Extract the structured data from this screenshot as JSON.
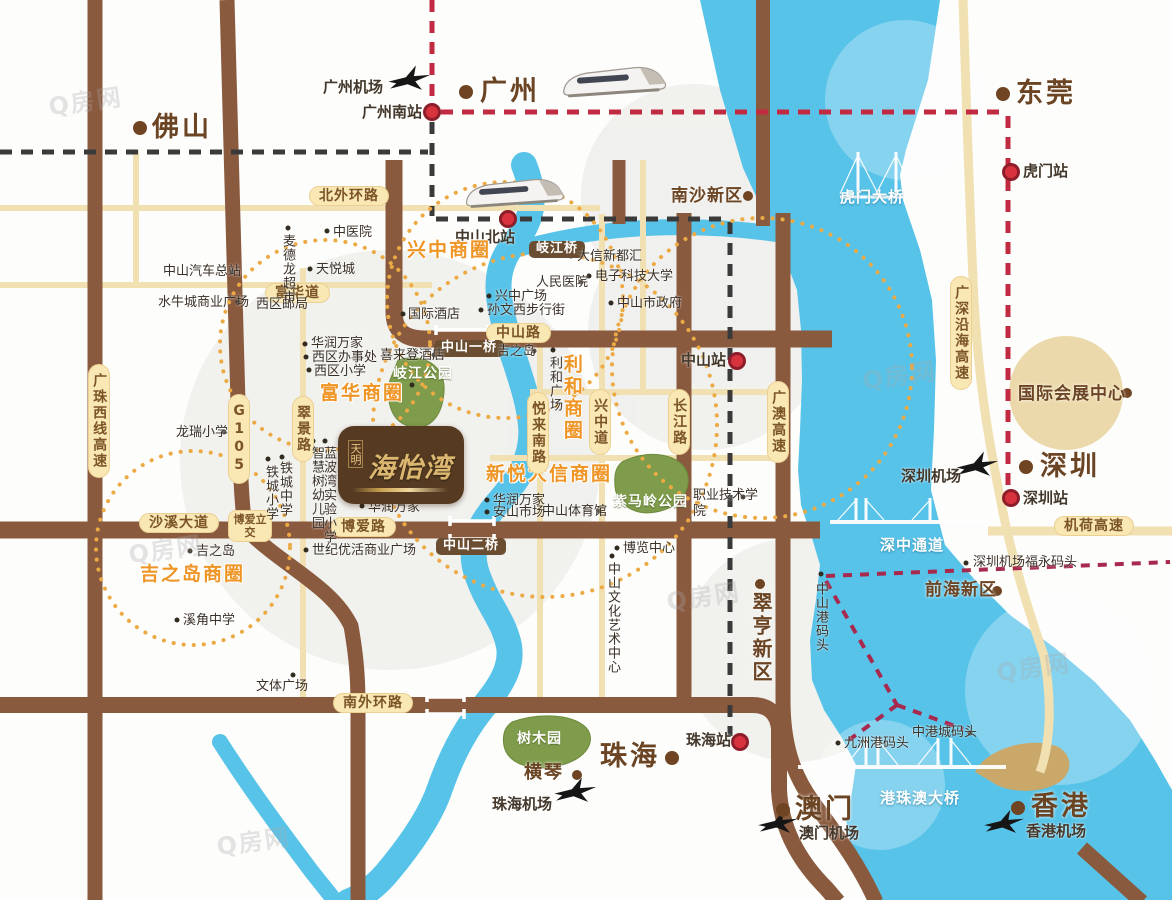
{
  "project": {
    "brand": "天明",
    "name": "海怡湾"
  },
  "watermark": {
    "text": "Q房网",
    "positions": [
      {
        "x": 48,
        "y": 82
      },
      {
        "x": 862,
        "y": 356
      },
      {
        "x": 666,
        "y": 577
      },
      {
        "x": 216,
        "y": 822
      },
      {
        "x": 996,
        "y": 648
      },
      {
        "x": 128,
        "y": 530
      }
    ]
  },
  "colors": {
    "road_major": "#8a5a3e",
    "road_minor": "#f1e0b2",
    "water": "#58c3e9",
    "park": "#7e9c4b",
    "biz_circle": "#ecaa45",
    "rail_dash_red": "#c22a42",
    "metro_dash_black": "#3a3a3a",
    "ferry_dash": "#a8294e",
    "city_dot": "#6f4422",
    "station_dot": "#d8323f",
    "pill_bg": "#f9e7b4"
  },
  "labels": [
    {
      "t": "佛山",
      "x": 152,
      "y": 112,
      "c": "city",
      "n": "label-foshan"
    },
    {
      "t": "广州",
      "x": 480,
      "y": 76,
      "c": "city",
      "n": "label-guangzhou"
    },
    {
      "t": "东莞",
      "x": 1016,
      "y": 78,
      "c": "city",
      "n": "label-dongguan"
    },
    {
      "t": "深圳",
      "x": 1040,
      "y": 451,
      "c": "city",
      "n": "label-shenzhen"
    },
    {
      "t": "珠海",
      "x": 600,
      "y": 741,
      "c": "city",
      "n": "label-zhuhai"
    },
    {
      "t": "澳门",
      "x": 795,
      "y": 794,
      "c": "city",
      "n": "label-macau"
    },
    {
      "t": "香港",
      "x": 1031,
      "y": 791,
      "c": "city",
      "n": "label-hongkong"
    },
    {
      "t": "横琴",
      "x": 524,
      "y": 763,
      "c": "citys",
      "n": "label-hengqin"
    },
    {
      "t": "南沙新区",
      "x": 671,
      "y": 187,
      "c": "area",
      "n": "label-nansha-new-district"
    },
    {
      "t": "前海新区",
      "x": 925,
      "y": 581,
      "c": "area",
      "n": "label-qianhai-new-district"
    },
    {
      "t": "国际会展中心",
      "x": 1018,
      "y": 385,
      "c": "area",
      "n": "label-intl-convention-center"
    },
    {
      "t": "翠亨新区",
      "x": 749,
      "y": 592,
      "c": "areav",
      "n": "label-cuiheng-new-district"
    },
    {
      "t": "广州机场",
      "x": 323,
      "y": 79,
      "c": "station",
      "n": "label-guangzhou-airport"
    },
    {
      "t": "广州南站",
      "x": 362,
      "y": 104,
      "c": "station",
      "n": "label-guangzhou-south-station"
    },
    {
      "t": "中山北站",
      "x": 455,
      "y": 229,
      "c": "station",
      "n": "label-zhongshan-north-station"
    },
    {
      "t": "虎门站",
      "x": 1023,
      "y": 163,
      "c": "station",
      "n": "label-humen-station"
    },
    {
      "t": "中山站",
      "x": 681,
      "y": 352,
      "c": "station",
      "n": "label-zhongshan-station"
    },
    {
      "t": "珠海站",
      "x": 686,
      "y": 732,
      "c": "station",
      "n": "label-zhuhai-station"
    },
    {
      "t": "深圳站",
      "x": 1023,
      "y": 490,
      "c": "station",
      "n": "label-shenzhen-station"
    },
    {
      "t": "深圳机场",
      "x": 901,
      "y": 468,
      "c": "station",
      "n": "label-shenzhen-airport"
    },
    {
      "t": "珠海机场",
      "x": 492,
      "y": 796,
      "c": "station",
      "n": "label-zhuhai-airport"
    },
    {
      "t": "澳门机场",
      "x": 799,
      "y": 825,
      "c": "station",
      "n": "label-macau-airport"
    },
    {
      "t": "香港机场",
      "x": 1026,
      "y": 823,
      "c": "station",
      "n": "label-hongkong-airport"
    },
    {
      "t": "兴中商圈",
      "x": 407,
      "y": 240,
      "c": "biz",
      "n": "label-xingzhong-biz-circle"
    },
    {
      "t": "富华商圈",
      "x": 320,
      "y": 383,
      "c": "biz",
      "n": "label-fuhua-biz-circle"
    },
    {
      "t": "新悦大信商圈",
      "x": 486,
      "y": 464,
      "c": "biz",
      "n": "label-xinyue-daxin-biz-circle"
    },
    {
      "t": "吉之岛商圈",
      "x": 140,
      "y": 564,
      "c": "biz",
      "n": "label-jusco-biz-circle"
    },
    {
      "t": "利和商圈",
      "x": 560,
      "y": 354,
      "c": "bizv",
      "n": "label-lihe-biz-circle"
    },
    {
      "t": "北外环路",
      "x": 309,
      "y": 186,
      "c": "pill",
      "n": "road-label-north-outer-ring"
    },
    {
      "t": "富华道",
      "x": 265,
      "y": 283,
      "c": "pill",
      "n": "road-label-fuhua-road"
    },
    {
      "t": "中山路",
      "x": 486,
      "y": 323,
      "c": "pill",
      "n": "road-label-zhongshan-road"
    },
    {
      "t": "博爱路",
      "x": 331,
      "y": 517,
      "c": "pill",
      "n": "road-label-boai-road"
    },
    {
      "t": "沙溪大道",
      "x": 139,
      "y": 513,
      "c": "pill",
      "n": "road-label-shaxi-avenue"
    },
    {
      "t": "南外环路",
      "x": 333,
      "y": 693,
      "c": "pill",
      "n": "road-label-south-outer-ring"
    },
    {
      "t": "机荷高速",
      "x": 1054,
      "y": 516,
      "c": "pill",
      "n": "road-label-jihe-expressway"
    },
    {
      "t": "广珠西线高速",
      "x": 88,
      "y": 364,
      "c": "pillv",
      "n": "road-label-guangzhu-west-expressway"
    },
    {
      "t": "G105",
      "x": 228,
      "y": 394,
      "c": "pillv",
      "n": "road-label-g105"
    },
    {
      "t": "翠景路",
      "x": 292,
      "y": 396,
      "c": "pillv",
      "n": "road-label-cuijing-road"
    },
    {
      "t": "兴中道",
      "x": 589,
      "y": 389,
      "c": "pillv",
      "n": "road-label-xingzhong-road"
    },
    {
      "t": "悦来南路",
      "x": 527,
      "y": 392,
      "c": "pillv",
      "n": "road-label-yuelai-south-road"
    },
    {
      "t": "长江路",
      "x": 668,
      "y": 389,
      "c": "pillv",
      "n": "road-label-changjiang-road"
    },
    {
      "t": "广澳高速",
      "x": 767,
      "y": 381,
      "c": "pillv",
      "n": "road-label-guangao-expressway"
    },
    {
      "t": "广深沿海高速",
      "x": 950,
      "y": 276,
      "c": "pillv",
      "n": "road-label-guangshen-coastal-expressway"
    },
    {
      "t": "博爱立交",
      "x": 228,
      "y": 510,
      "c": "pill2",
      "w": 34,
      "n": "road-label-boai-interchange"
    },
    {
      "t": "岐江桥",
      "x": 529,
      "y": 241,
      "c": "pilld",
      "n": "bridge-label-qijiang-bridge"
    },
    {
      "t": "中山一桥",
      "x": 434,
      "y": 340,
      "c": "pilld",
      "n": "bridge-label-zhongshan-bridge-1"
    },
    {
      "t": "中山二桥",
      "x": 436,
      "y": 538,
      "c": "pilld",
      "n": "bridge-label-zhongshan-bridge-2"
    },
    {
      "t": "虎门大桥",
      "x": 840,
      "y": 189,
      "c": "water",
      "n": "bridge-label-humen-bridge"
    },
    {
      "t": "深中通道",
      "x": 880,
      "y": 537,
      "c": "water",
      "n": "bridge-label-shenzhong-corridor"
    },
    {
      "t": "港珠澳大桥",
      "x": 880,
      "y": 790,
      "c": "water",
      "n": "bridge-label-hzm-bridge"
    },
    {
      "t": "岐江公园",
      "x": 393,
      "y": 366,
      "c": "park",
      "n": "park-label-qijiang-park"
    },
    {
      "t": "紫马岭公园",
      "x": 613,
      "y": 494,
      "c": "park",
      "n": "park-label-zimaling-park"
    },
    {
      "t": "树木园",
      "x": 517,
      "y": 731,
      "c": "park",
      "n": "park-label-arboretum"
    },
    {
      "t": "中山汽车总站",
      "x": 163,
      "y": 265,
      "c": "poi",
      "n": "poi-zhongshan-bus-terminal"
    },
    {
      "t": "水牛城商业广场",
      "x": 158,
      "y": 296,
      "c": "poi",
      "n": "poi-shuiniucheng-plaza"
    },
    {
      "t": "中医院",
      "x": 333,
      "y": 226,
      "c": "poi",
      "n": "poi-tcm-hospital"
    },
    {
      "t": "天悦城",
      "x": 316,
      "y": 263,
      "c": "poi",
      "n": "poi-tianyue-city"
    },
    {
      "t": "西区邮局",
      "x": 256,
      "y": 298,
      "c": "poi",
      "n": "poi-west-post-office"
    },
    {
      "t": "华润万家",
      "x": 311,
      "y": 337,
      "c": "poi",
      "n": "poi-vanguard-1"
    },
    {
      "t": "西区办事处",
      "x": 312,
      "y": 351,
      "c": "poi",
      "n": "poi-west-district-office"
    },
    {
      "t": "西区小学",
      "x": 314,
      "y": 365,
      "c": "poi",
      "n": "poi-west-primary-school"
    },
    {
      "t": "国际酒店",
      "x": 408,
      "y": 308,
      "c": "poi",
      "n": "poi-international-hotel"
    },
    {
      "t": "喜来登酒店",
      "x": 380,
      "y": 349,
      "c": "poi",
      "n": "poi-sheraton-hotel"
    },
    {
      "t": "龙瑞小学",
      "x": 176,
      "y": 426,
      "c": "poi",
      "n": "poi-longrui-primary-school"
    },
    {
      "t": "吉之岛",
      "x": 196,
      "y": 545,
      "c": "poi",
      "n": "poi-jusco-south"
    },
    {
      "t": "溪角中学",
      "x": 183,
      "y": 614,
      "c": "poi",
      "n": "poi-xijiao-middle-school"
    },
    {
      "t": "文体广场",
      "x": 256,
      "y": 680,
      "c": "poi",
      "n": "poi-culture-sports-plaza"
    },
    {
      "t": "世纪优活商业广场",
      "x": 312,
      "y": 544,
      "c": "poi",
      "n": "poi-century-youhuo-plaza"
    },
    {
      "t": "华润万家",
      "x": 368,
      "y": 501,
      "c": "poi",
      "n": "poi-vanguard-2"
    },
    {
      "t": "华润万家",
      "x": 493,
      "y": 494,
      "c": "poi",
      "n": "poi-vanguard-3"
    },
    {
      "t": "安山市场",
      "x": 493,
      "y": 506,
      "c": "poi",
      "n": "poi-anshan-market"
    },
    {
      "t": "中山体育馆",
      "x": 542,
      "y": 505,
      "c": "poi",
      "n": "poi-zhongshan-gymnasium"
    },
    {
      "t": "博览中心",
      "x": 623,
      "y": 542,
      "c": "poi",
      "n": "poi-expo-center"
    },
    {
      "t": "兴中广场",
      "x": 495,
      "y": 290,
      "c": "poi",
      "n": "poi-xingzhong-plaza"
    },
    {
      "t": "孙文西步行街",
      "x": 487,
      "y": 304,
      "c": "poi",
      "n": "poi-sunwen-west-walking-street"
    },
    {
      "t": "人民医院",
      "x": 536,
      "y": 276,
      "c": "poi",
      "n": "poi-people-hospital"
    },
    {
      "t": "大信新都汇",
      "x": 577,
      "y": 250,
      "c": "poi",
      "n": "poi-daxin-xinduhui"
    },
    {
      "t": "电子科技大学",
      "x": 595,
      "y": 270,
      "c": "poi",
      "n": "poi-uestc"
    },
    {
      "t": "中山市政府",
      "x": 617,
      "y": 297,
      "c": "poi",
      "n": "poi-zhongshan-government"
    },
    {
      "t": "吉之岛",
      "x": 497,
      "y": 345,
      "c": "poi",
      "n": "poi-jusco-north"
    },
    {
      "t": "职业技术学院",
      "x": 693,
      "y": 488,
      "c": "poi wrap",
      "w": 66,
      "n": "poi-polytechnic-college"
    },
    {
      "t": "九洲港码头",
      "x": 844,
      "y": 737,
      "c": "poi",
      "n": "poi-jiuzhou-port-pier"
    },
    {
      "t": "中港城码头",
      "x": 912,
      "y": 726,
      "c": "poi",
      "n": "poi-zhonggangcheng-pier"
    },
    {
      "t": "深圳机场福永码头",
      "x": 973,
      "y": 556,
      "c": "poi",
      "n": "poi-fuyong-pier"
    },
    {
      "t": "麦德龙超市",
      "x": 279,
      "y": 234,
      "c": "poiv",
      "n": "poi-metro-supermarket"
    },
    {
      "t": "铁城小学",
      "x": 262,
      "y": 465,
      "c": "poiv",
      "n": "poi-tiecheng-primary"
    },
    {
      "t": "铁城中学",
      "x": 276,
      "y": 461,
      "c": "poiv",
      "n": "poi-tiecheng-middle"
    },
    {
      "t": "智慧树幼儿园",
      "x": 308,
      "y": 446,
      "c": "poiv",
      "n": "poi-zhihuishu-kindergarten"
    },
    {
      "t": "蓝波湾实验小学",
      "x": 320,
      "y": 446,
      "c": "poiv",
      "n": "poi-lanbowan-primary"
    },
    {
      "t": "利和广场",
      "x": 546,
      "y": 356,
      "c": "poiv",
      "n": "poi-lihe-plaza"
    },
    {
      "t": "中山文化艺术中心",
      "x": 604,
      "y": 562,
      "c": "poiv",
      "n": "poi-culture-art-center"
    },
    {
      "t": "中山港码头",
      "x": 812,
      "y": 582,
      "c": "poiv",
      "n": "poi-zhongshan-port-pier"
    }
  ],
  "dots": [
    {
      "x": 140,
      "y": 128,
      "t": "c"
    },
    {
      "x": 466,
      "y": 92,
      "t": "c"
    },
    {
      "x": 1003,
      "y": 94,
      "t": "c"
    },
    {
      "x": 1026,
      "y": 467,
      "t": "c"
    },
    {
      "x": 672,
      "y": 758,
      "t": "c"
    },
    {
      "x": 783,
      "y": 810,
      "t": "c"
    },
    {
      "x": 1018,
      "y": 808,
      "t": "c"
    },
    {
      "x": 577,
      "y": 775,
      "t": "cs"
    },
    {
      "x": 748,
      "y": 196,
      "t": "cs"
    },
    {
      "x": 997,
      "y": 591,
      "t": "cs"
    },
    {
      "x": 760,
      "y": 584,
      "t": "cs"
    },
    {
      "x": 1127,
      "y": 393,
      "t": "cs"
    },
    {
      "x": 432,
      "y": 112,
      "t": "s"
    },
    {
      "x": 508,
      "y": 219,
      "t": "s"
    },
    {
      "x": 1011,
      "y": 172,
      "t": "s"
    },
    {
      "x": 737,
      "y": 361,
      "t": "s"
    },
    {
      "x": 740,
      "y": 742,
      "t": "s"
    },
    {
      "x": 1011,
      "y": 498,
      "t": "s"
    },
    {
      "x": 232,
      "y": 272,
      "t": "p"
    },
    {
      "x": 238,
      "y": 302,
      "t": "p"
    },
    {
      "x": 288,
      "y": 228,
      "t": "p"
    },
    {
      "x": 327,
      "y": 231,
      "t": "p"
    },
    {
      "x": 310,
      "y": 269,
      "t": "p"
    },
    {
      "x": 290,
      "y": 292,
      "t": "p"
    },
    {
      "x": 305,
      "y": 344,
      "t": "p"
    },
    {
      "x": 306,
      "y": 357,
      "t": "p"
    },
    {
      "x": 309,
      "y": 370,
      "t": "p"
    },
    {
      "x": 403,
      "y": 314,
      "t": "p"
    },
    {
      "x": 434,
      "y": 355,
      "t": "p"
    },
    {
      "x": 224,
      "y": 432,
      "t": "p"
    },
    {
      "x": 268,
      "y": 459,
      "t": "p"
    },
    {
      "x": 282,
      "y": 457,
      "t": "p"
    },
    {
      "x": 313,
      "y": 441,
      "t": "p"
    },
    {
      "x": 325,
      "y": 441,
      "t": "p"
    },
    {
      "x": 190,
      "y": 551,
      "t": "p"
    },
    {
      "x": 177,
      "y": 620,
      "t": "p"
    },
    {
      "x": 293,
      "y": 675,
      "t": "p"
    },
    {
      "x": 306,
      "y": 550,
      "t": "p"
    },
    {
      "x": 412,
      "y": 385,
      "t": "p"
    },
    {
      "x": 362,
      "y": 506,
      "t": "p"
    },
    {
      "x": 487,
      "y": 500,
      "t": "p"
    },
    {
      "x": 487,
      "y": 512,
      "t": "p"
    },
    {
      "x": 599,
      "y": 511,
      "t": "p"
    },
    {
      "x": 617,
      "y": 548,
      "t": "p"
    },
    {
      "x": 612,
      "y": 556,
      "t": "p"
    },
    {
      "x": 489,
      "y": 296,
      "t": "p"
    },
    {
      "x": 481,
      "y": 310,
      "t": "p"
    },
    {
      "x": 581,
      "y": 282,
      "t": "p"
    },
    {
      "x": 571,
      "y": 256,
      "t": "p"
    },
    {
      "x": 589,
      "y": 276,
      "t": "p"
    },
    {
      "x": 611,
      "y": 303,
      "t": "p"
    },
    {
      "x": 534,
      "y": 351,
      "t": "p"
    },
    {
      "x": 553,
      "y": 350,
      "t": "p"
    },
    {
      "x": 743,
      "y": 497,
      "t": "p"
    },
    {
      "x": 838,
      "y": 743,
      "t": "p"
    },
    {
      "x": 970,
      "y": 733,
      "t": "p"
    },
    {
      "x": 966,
      "y": 563,
      "t": "p"
    },
    {
      "x": 821,
      "y": 574,
      "t": "p"
    }
  ]
}
